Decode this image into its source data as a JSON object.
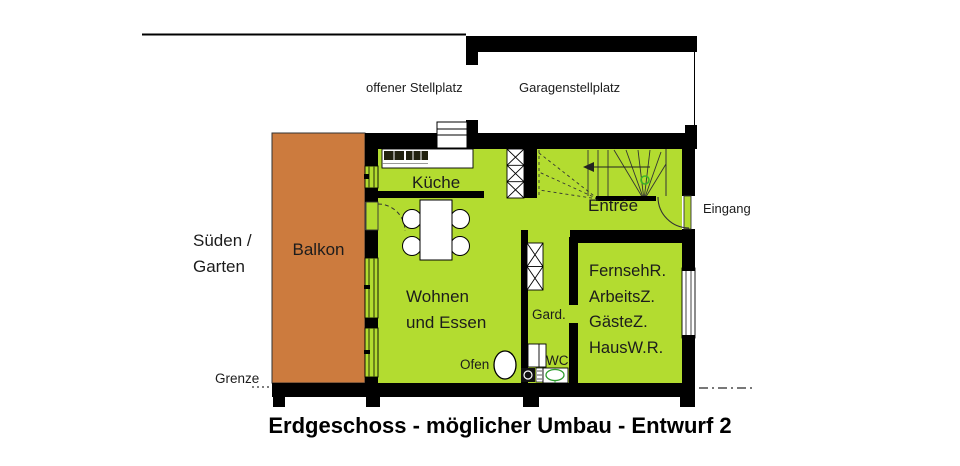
{
  "title": "Erdgeschoss - möglicher Umbau - Entwurf 2",
  "site": {
    "offener_stellplatz": "offener Stellplatz",
    "garagenstellplatz": "Garagenstellplatz",
    "sueden_garten_line1": "Süden /",
    "sueden_garten_line2": "Garten",
    "grenze": "Grenze",
    "eingang": "Eingang"
  },
  "rooms": {
    "balkon": "Balkon",
    "kueche": "Küche",
    "entree": "Entrée",
    "wohnen_line1": "Wohnen",
    "wohnen_line2": "und Essen",
    "gard": "Gard.",
    "wc": "WC",
    "ofen": "Ofen",
    "multi_room_lines": [
      "FernsehR.",
      "ArbeitsZ.",
      "GästeZ.",
      "HausW.R."
    ]
  },
  "colors": {
    "room_green": "#b3dc30",
    "balcony_orange": "#cc7b3e",
    "wall_black": "#000000",
    "toilet_green": "#2f9e2f",
    "stair_marker_green": "#3db32a"
  }
}
